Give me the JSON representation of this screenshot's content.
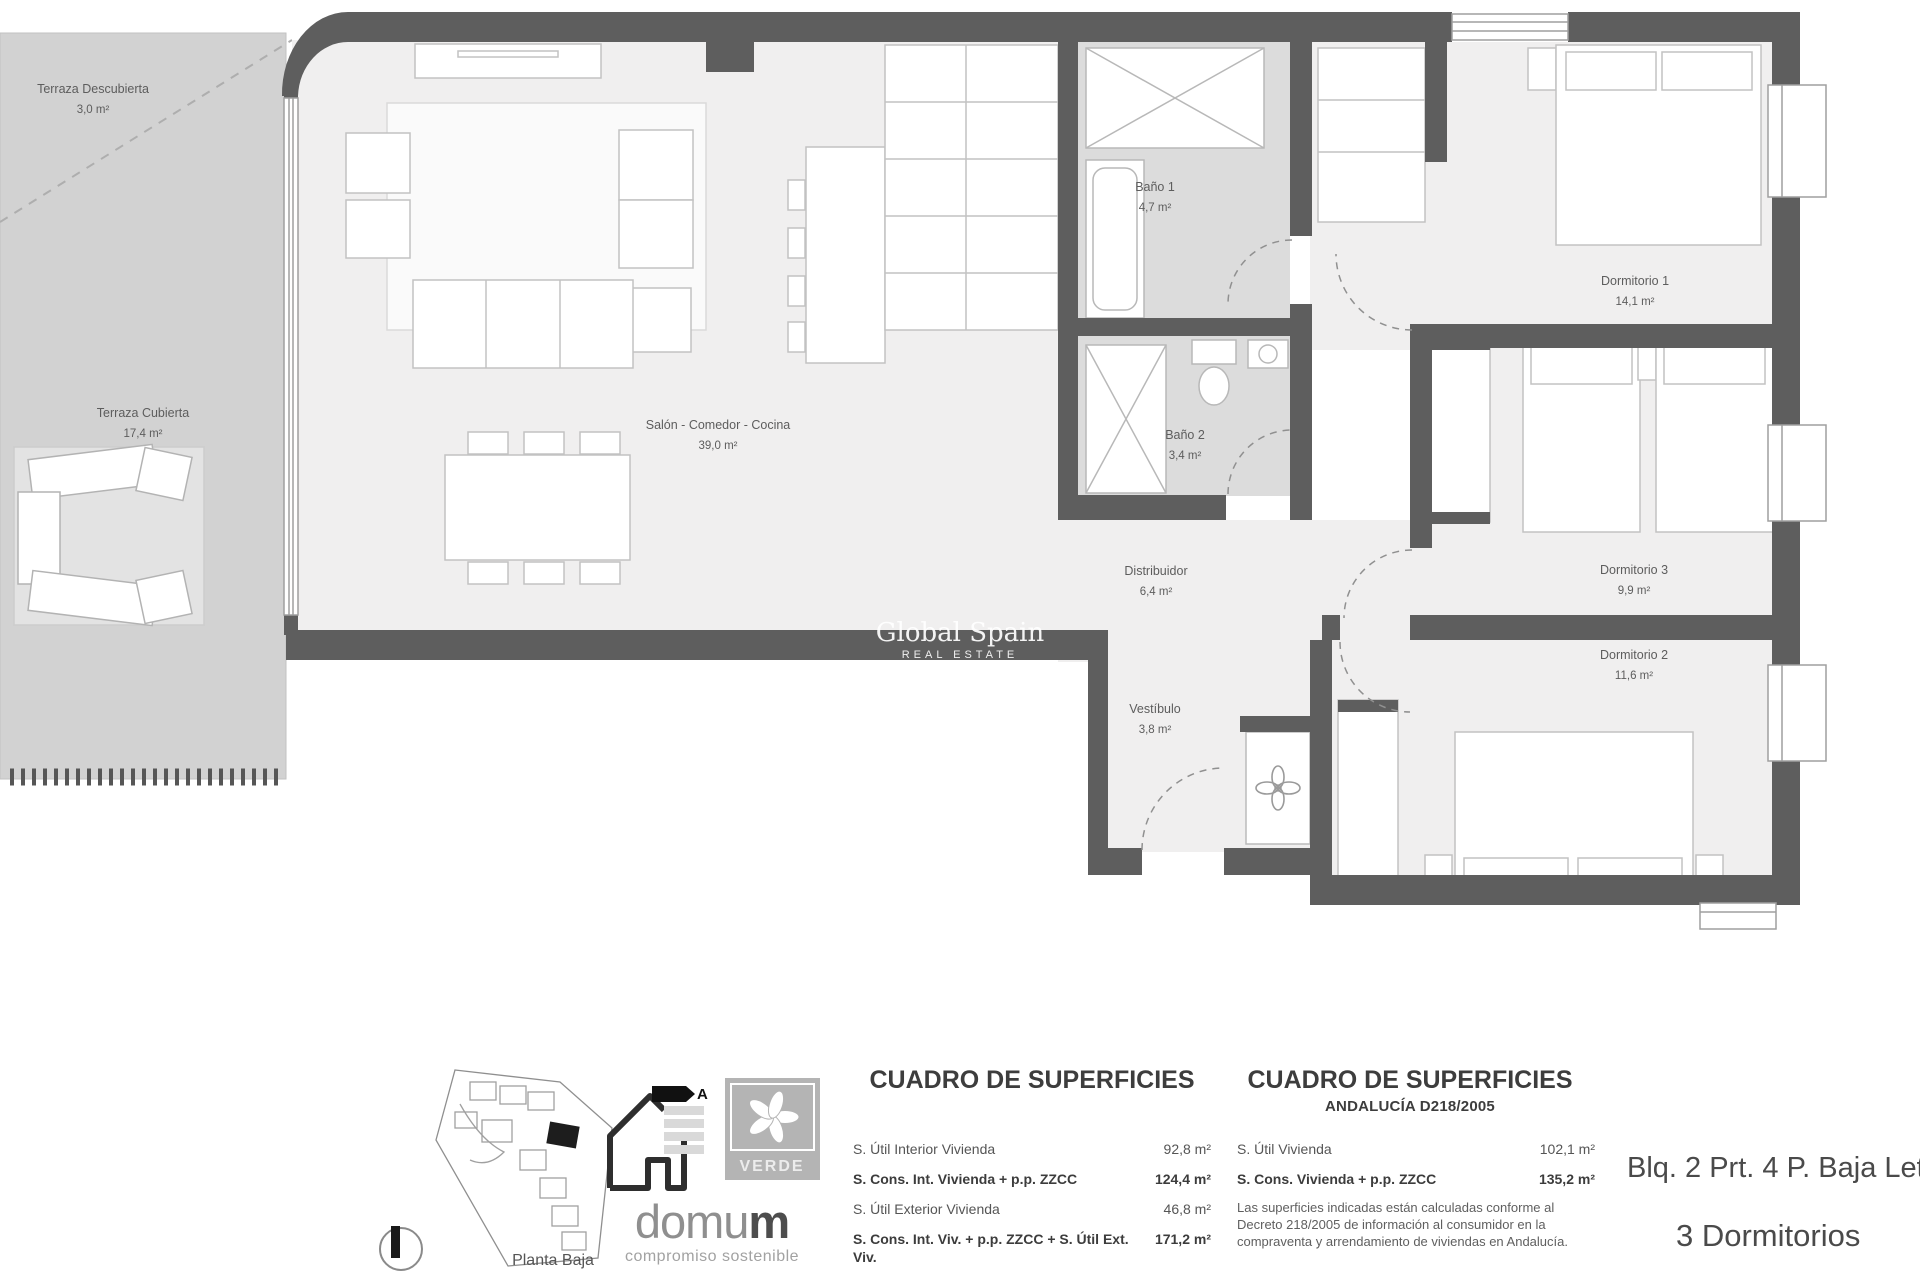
{
  "plan": {
    "watermark": {
      "title": "Global Spain",
      "subtitle": "REAL ESTATE"
    },
    "rooms": {
      "terraza_descubierta": {
        "name": "Terraza Descubierta",
        "area": "3,0 m²"
      },
      "terraza_cubierta": {
        "name": "Terraza Cubierta",
        "area": "17,4 m²"
      },
      "salon": {
        "name": "Salón - Comedor - Cocina",
        "area": "39,0 m²"
      },
      "bano1": {
        "name": "Baño 1",
        "area": "4,7 m²"
      },
      "bano2": {
        "name": "Baño 2",
        "area": "3,4 m²"
      },
      "dormitorio1": {
        "name": "Dormitorio 1",
        "area": "14,1 m²"
      },
      "dormitorio3": {
        "name": "Dormitorio 3",
        "area": "9,9 m²"
      },
      "dormitorio2": {
        "name": "Dormitorio 2",
        "area": "11,6 m²"
      },
      "distribuidor": {
        "name": "Distribuidor",
        "area": "6,4 m²"
      },
      "vestibulo": {
        "name": "Vestíbulo",
        "area": "3,8 m²"
      }
    }
  },
  "legend": {
    "site": {
      "label": "Planta Baja"
    },
    "energy": {
      "rating": "A"
    },
    "verde": {
      "label": "VERDE"
    },
    "brand": {
      "word_light": "domu",
      "word_bold": "m",
      "tagline": "compromiso sostenible"
    },
    "table_general": {
      "title": "CUADRO DE SUPERFICIES",
      "rows": [
        {
          "label": "S. Útil Interior Vivienda",
          "value": "92,8 m²"
        },
        {
          "label": "S. Cons. Int. Vivienda + p.p. ZZCC",
          "value": "124,4 m²"
        },
        {
          "label": "S. Útil Exterior Vivienda",
          "value": "46,8 m²"
        },
        {
          "label": "S. Cons. Int. Viv. + p.p. ZZCC + S. Útil Ext. Viv.",
          "value": "171,2 m²"
        }
      ]
    },
    "table_andalucia": {
      "title": "CUADRO DE SUPERFICIES",
      "subtitle": "ANDALUCÍA D218/2005",
      "rows": [
        {
          "label": "S. Útil Vivienda",
          "value": "102,1 m²"
        },
        {
          "label": "S. Cons. Vivienda + p.p. ZZCC",
          "value": "135,2 m²"
        }
      ],
      "note": "Las superficies indicadas están calculadas conforme al Decreto 218/2005 de información al consumidor en la compraventa y arrendamiento de viviendas en Andalucía."
    },
    "unit": {
      "reference": "Blq. 2 Prt. 4 P. Baja Letra A",
      "type": "3 Dormitorios"
    }
  },
  "colors": {
    "wall": "#5e5e5e",
    "terrace": "#d2d2d2",
    "floor": "#f0efef",
    "bath_floor": "#dcdcdc",
    "label_text": "#5d5d5d",
    "watermark": "#ffffff"
  }
}
